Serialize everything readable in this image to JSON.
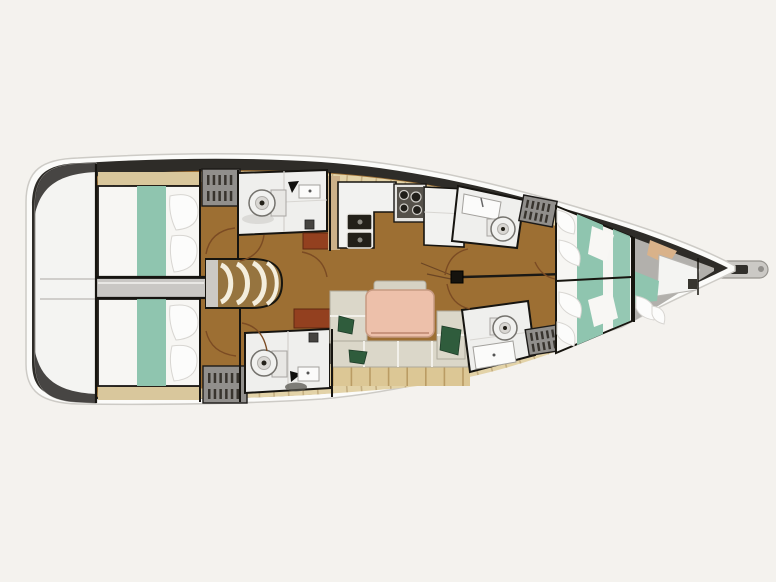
{
  "page": {
    "width": 776,
    "height": 582,
    "description": "Scanned top-down interior layout plan of a sailing yacht, bow pointing right, stern with swim platform at left"
  },
  "boat": {
    "orientation": {
      "bow": "right",
      "stern": "left"
    },
    "rooms": [
      {
        "id": "stern-platform",
        "label": "Stern swim platform"
      },
      {
        "id": "aft-port-cabin",
        "label": "Aft port double cabin"
      },
      {
        "id": "aft-starboard-cabin",
        "label": "Aft starboard double cabin"
      },
      {
        "id": "companionway",
        "label": "Companionway steps and engine box"
      },
      {
        "id": "aft-port-head",
        "label": "Aft port head with toilet and sink"
      },
      {
        "id": "aft-starboard-head",
        "label": "Aft starboard head with toilet and sink"
      },
      {
        "id": "galley",
        "label": "Galley with stove and double sink"
      },
      {
        "id": "salon",
        "label": "Salon with U-shaped settee and dining table"
      },
      {
        "id": "forward-port-head",
        "label": "Forward port head"
      },
      {
        "id": "forward-starboard-head",
        "label": "Forward starboard head"
      },
      {
        "id": "forward-cabin",
        "label": "Forward V-berth cabin"
      },
      {
        "id": "bow-compartment",
        "label": "Bow compartment with vanity"
      },
      {
        "id": "bowsprit",
        "label": "Bowsprit with anchor roller"
      }
    ],
    "counts": {
      "sleeping_cabins": 3,
      "toilets": 4,
      "wardrobes": 4,
      "companionway_steps": 4
    },
    "fixtures": [
      "toilet-icon",
      "sink-icon",
      "double-sink-icon",
      "stove-icon",
      "steps-icon",
      "mast-icon",
      "wardrobe-icon",
      "bed-icon",
      "pillow-icon",
      "table-icon",
      "settee-icon",
      "plant-icon",
      "bowsprit-icon"
    ],
    "colors": {
      "page": "#f4f2ee",
      "shell": "#fbfbf9",
      "shellEdge": "#cdcbc6",
      "band": "#2e2c28",
      "wood": "#9d6f33",
      "deck": "#e3d3a8",
      "deckTick": "#bfa87a",
      "tan": "#d9c79c",
      "bed": "#f7f6f3",
      "teal": "#8fc5af",
      "head": "#efefed",
      "locker": "#918f8c",
      "lockerStripe": "#38342e",
      "strip": "#c9c7c4",
      "stepBase": "#96743f",
      "stepArc": "#f4eedd",
      "settee": "#dbd7c9",
      "table": "#edc0aa",
      "plant": "#2f5c3c",
      "cabinet": "#93401f",
      "bowFloor": "#b2b0ac",
      "sprit": "#cbc9c5",
      "line": "#161410",
      "arc": "#7b4b23",
      "plank": "#b29258"
    }
  }
}
